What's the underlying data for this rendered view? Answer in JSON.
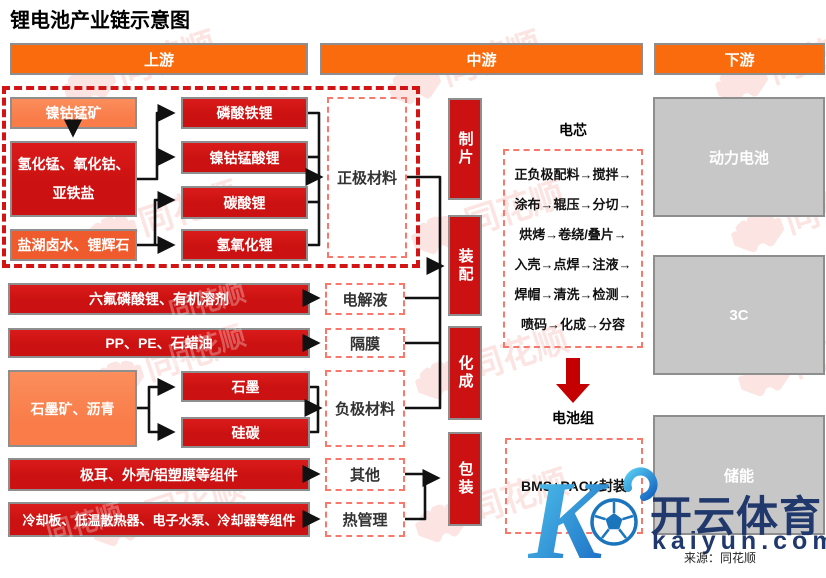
{
  "title": "锂电池产业链示意图",
  "headers": {
    "upstream": "上游",
    "midstream": "中游",
    "downstream": "下游"
  },
  "upstream": {
    "ore": "镍钴锰矿",
    "precursors": "氢化锰、氧化钴、亚铁盐",
    "brine": "盐湖卤水、锂辉石",
    "lfp": "磷酸铁锂",
    "ncm": "镍钴锰酸锂",
    "li2co3": "碳酸锂",
    "lioh": "氢氧化锂",
    "cathode": "正极材料"
  },
  "rows": {
    "electrolyte_src": "六氟磷酸锂、有机溶剂",
    "electrolyte": "电解液",
    "separator_src": "PP、PE、石蜡油",
    "separator": "隔膜",
    "anode_src": "石墨矿、沥青",
    "graphite": "石墨",
    "silicon_carbon": "硅碳",
    "anode": "负极材料",
    "others_src": "极耳、外壳/铝塑膜等组件",
    "others": "其他",
    "thermal_src": "冷却板、低温散热器、电子水泵、冷却器等组件",
    "thermal": "热管理"
  },
  "process": {
    "p0": "制片",
    "p1": "装配",
    "p2": "化成",
    "p3": "包装"
  },
  "cell": {
    "label": "电芯",
    "steps": [
      "正负极配料→搅拌→",
      "涂布→辊压→分切→",
      "烘烤→卷绕/叠片→",
      "入壳→点焊→注液→",
      "焊帽→清洗→检测→",
      "喷码→化成→分容"
    ]
  },
  "pack": {
    "label": "电池组",
    "content": "BMS+PACK封装"
  },
  "downstream": {
    "power": "动力电池",
    "consumer": "3C",
    "storage": "储能"
  },
  "watermark": {
    "brand": "同花顺"
  },
  "footer": {
    "source": "来源：同花顺"
  },
  "kaiyun": {
    "name": "开云体育",
    "domain": "kaiyun.com"
  },
  "colors": {
    "orange": "#F96B0D",
    "lightOrange": "#F97C49",
    "redOrange": "#EF5B2D",
    "deepRed": "#CB1111",
    "dashRed": "#D31414",
    "salmon": "#F8786B",
    "grayFill": "#C7C7C7",
    "grayBorder": "#8E8E8E",
    "navy": "#20386B",
    "kaiyunBlue": "#2BA8E0"
  }
}
